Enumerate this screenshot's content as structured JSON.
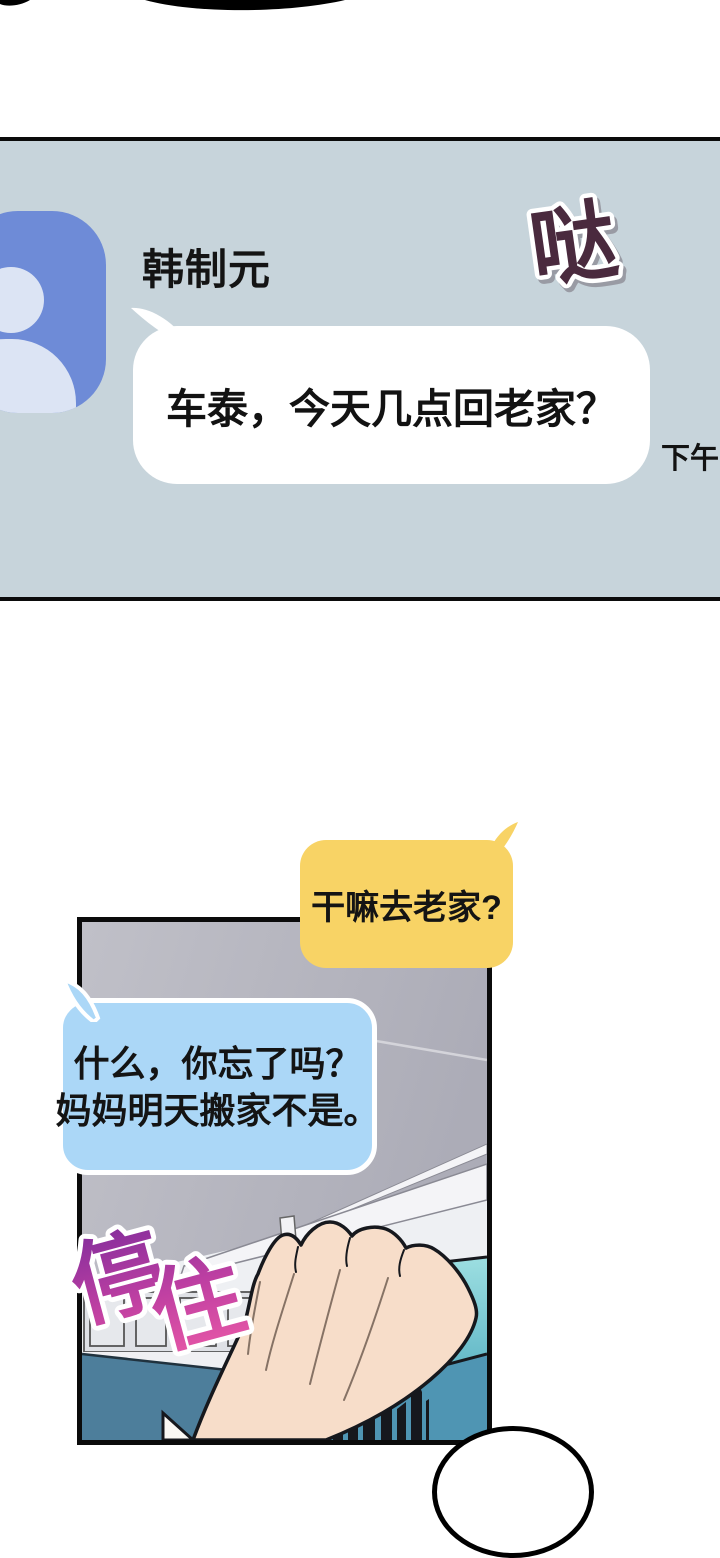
{
  "messenger": {
    "contact_name": "韩制元",
    "sfx": "哒",
    "message_text": "车泰，今天几点回老家？",
    "timestamp": "下午",
    "avatar_icon": "person-icon"
  },
  "comic": {
    "yellow_bubble_text": "干嘛去老家?",
    "blue_bubble_lines": [
      "什么，你忘了吗？",
      "妈妈明天搬家不是。"
    ],
    "sfx_chars": [
      "停",
      "住"
    ]
  },
  "colors": {
    "panel_bg": "#c7d4db",
    "avatar_bg": "#6e8bd7",
    "bubble_yellow": "#f8d365",
    "bubble_blue": "#abd7f7",
    "sfx_da_fill": "#4a2a3e",
    "sfx_stop_gradient_top": "#7d2b9b",
    "sfx_stop_gradient_bottom": "#f45fa8",
    "comic_gray": "#b6b6bf",
    "partition_teal_light": "#93d6da",
    "partition_teal_dark": "#4f95b3",
    "partition_left_blue": "#4d7e9b",
    "skin": "#f7ddc9"
  }
}
